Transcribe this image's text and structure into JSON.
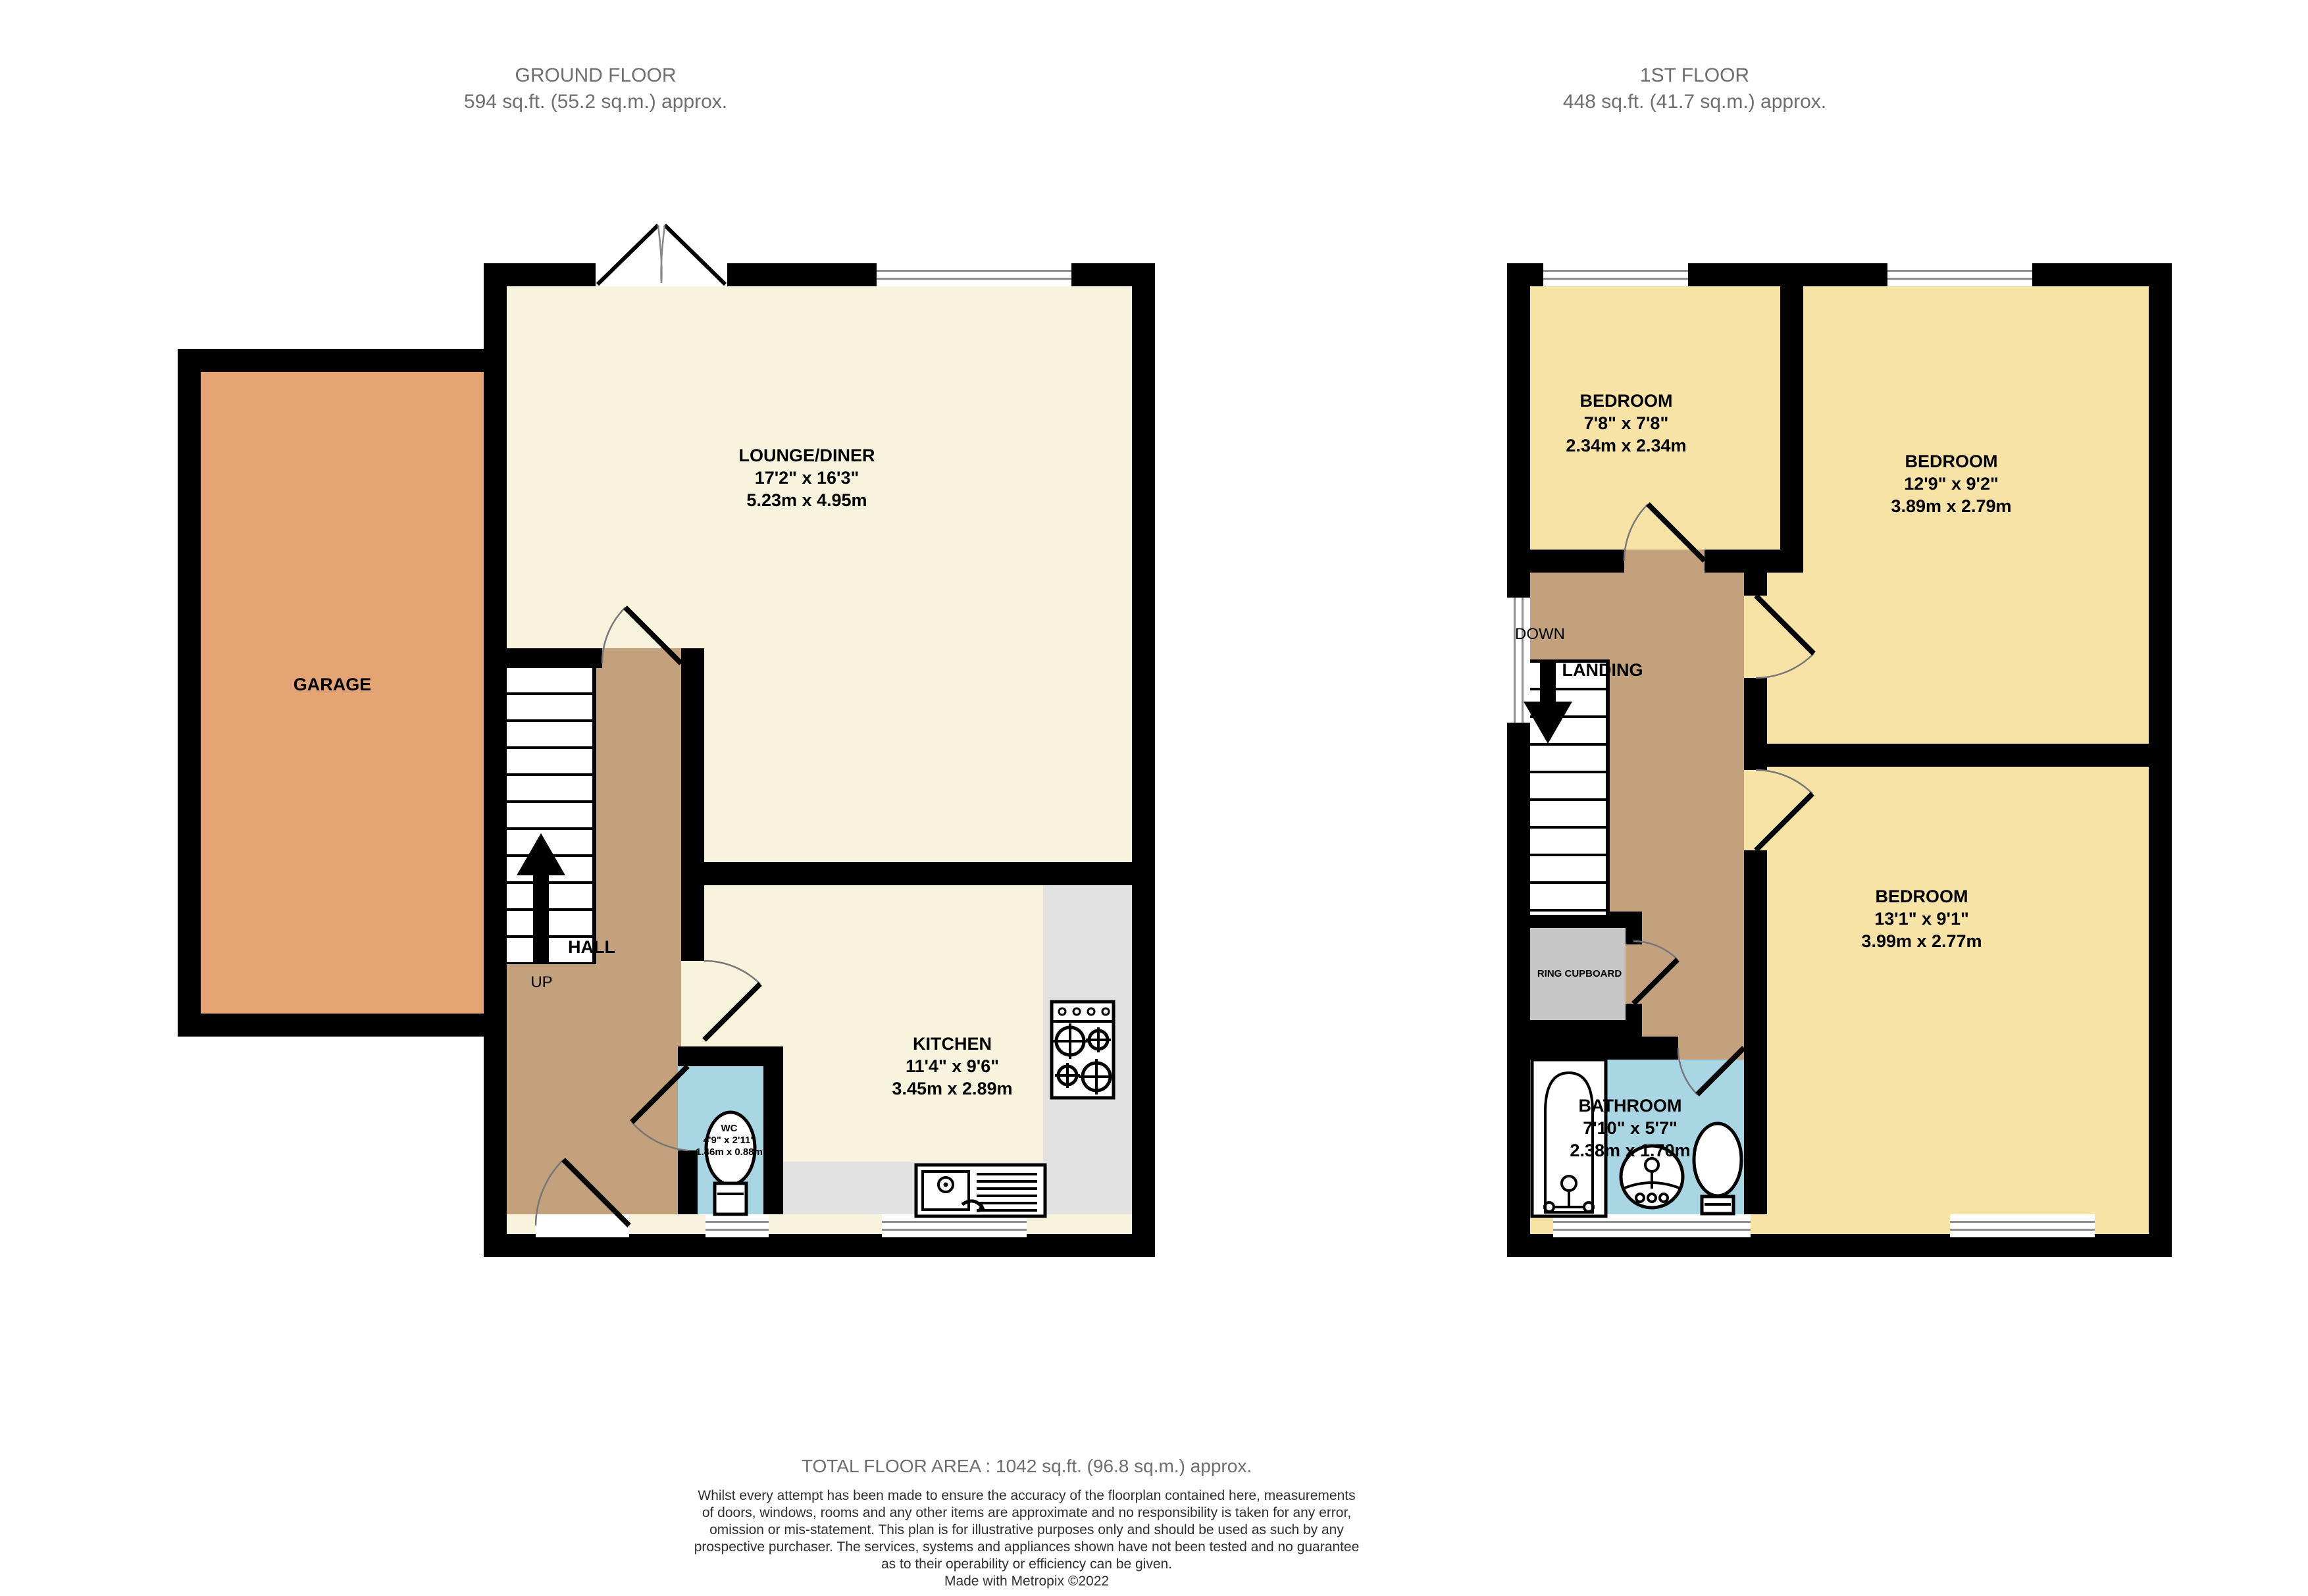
{
  "colors": {
    "wall": "#000000",
    "lounge_kitchen_cream": "#F8F3DD",
    "bedroom_yellow": "#F6E3A5",
    "hall_landing_tan": "#C3A17D",
    "garage_orange": "#E5A474",
    "bathroom_blue": "#A9D6E3",
    "counter_grey": "#E2E2E2",
    "cupboard_grey": "#C6C6C6",
    "title_grey": "#6F6F6F"
  },
  "ground_floor": {
    "title": "GROUND FLOOR",
    "subtitle": "594 sq.ft. (55.2 sq.m.) approx.",
    "rooms": {
      "garage": {
        "name": "GARAGE"
      },
      "lounge": {
        "name": "LOUNGE/DINER",
        "imperial": "17'2\"  x 16'3\"",
        "metric": "5.23m  x 4.95m"
      },
      "kitchen": {
        "name": "KITCHEN",
        "imperial": "11'4\"  x 9'6\"",
        "metric": "3.45m  x 2.89m"
      },
      "hall": {
        "name": "HALL",
        "stair_direction": "UP"
      },
      "wc": {
        "name": "WC",
        "imperial": "4'9\"  x 2'11\"",
        "metric": "1.46m  x 0.88m"
      }
    }
  },
  "first_floor": {
    "title": "1ST FLOOR",
    "subtitle": "448 sq.ft. (41.7 sq.m.) approx.",
    "rooms": {
      "bedroom_small": {
        "name": "BEDROOM",
        "imperial": "7'8\"  x 7'8\"",
        "metric": "2.34m  x 2.34m"
      },
      "bedroom_rear": {
        "name": "BEDROOM",
        "imperial": "12'9\"  x 9'2\"",
        "metric": "3.89m  x 2.79m"
      },
      "bedroom_front": {
        "name": "BEDROOM",
        "imperial": "13'1\"  x 9'1\"",
        "metric": "3.99m  x 2.77m"
      },
      "landing": {
        "name": "LANDING",
        "stair_direction": "DOWN"
      },
      "airing_cupboard": {
        "name": "RING CUPBOARD"
      },
      "bathroom": {
        "name": "BATHROOM",
        "imperial": "7'10\"  x 5'7\"",
        "metric": "2.38m  x 1.70m"
      }
    }
  },
  "footer": {
    "total_area": "TOTAL FLOOR AREA : 1042 sq.ft. (96.8 sq.m.) approx.",
    "disclaimer": [
      "Whilst every attempt has been made to ensure the accuracy of the floorplan contained here, measurements",
      "of doors, windows, rooms and any other items are approximate and no responsibility is taken for any error,",
      "omission or mis-statement. This plan is for illustrative purposes only and should be used as such by any",
      "prospective purchaser. The services, systems and appliances shown have not been tested and no guarantee",
      "as to their operability or efficiency can be given."
    ],
    "credit": "Made with Metropix ©2022"
  }
}
